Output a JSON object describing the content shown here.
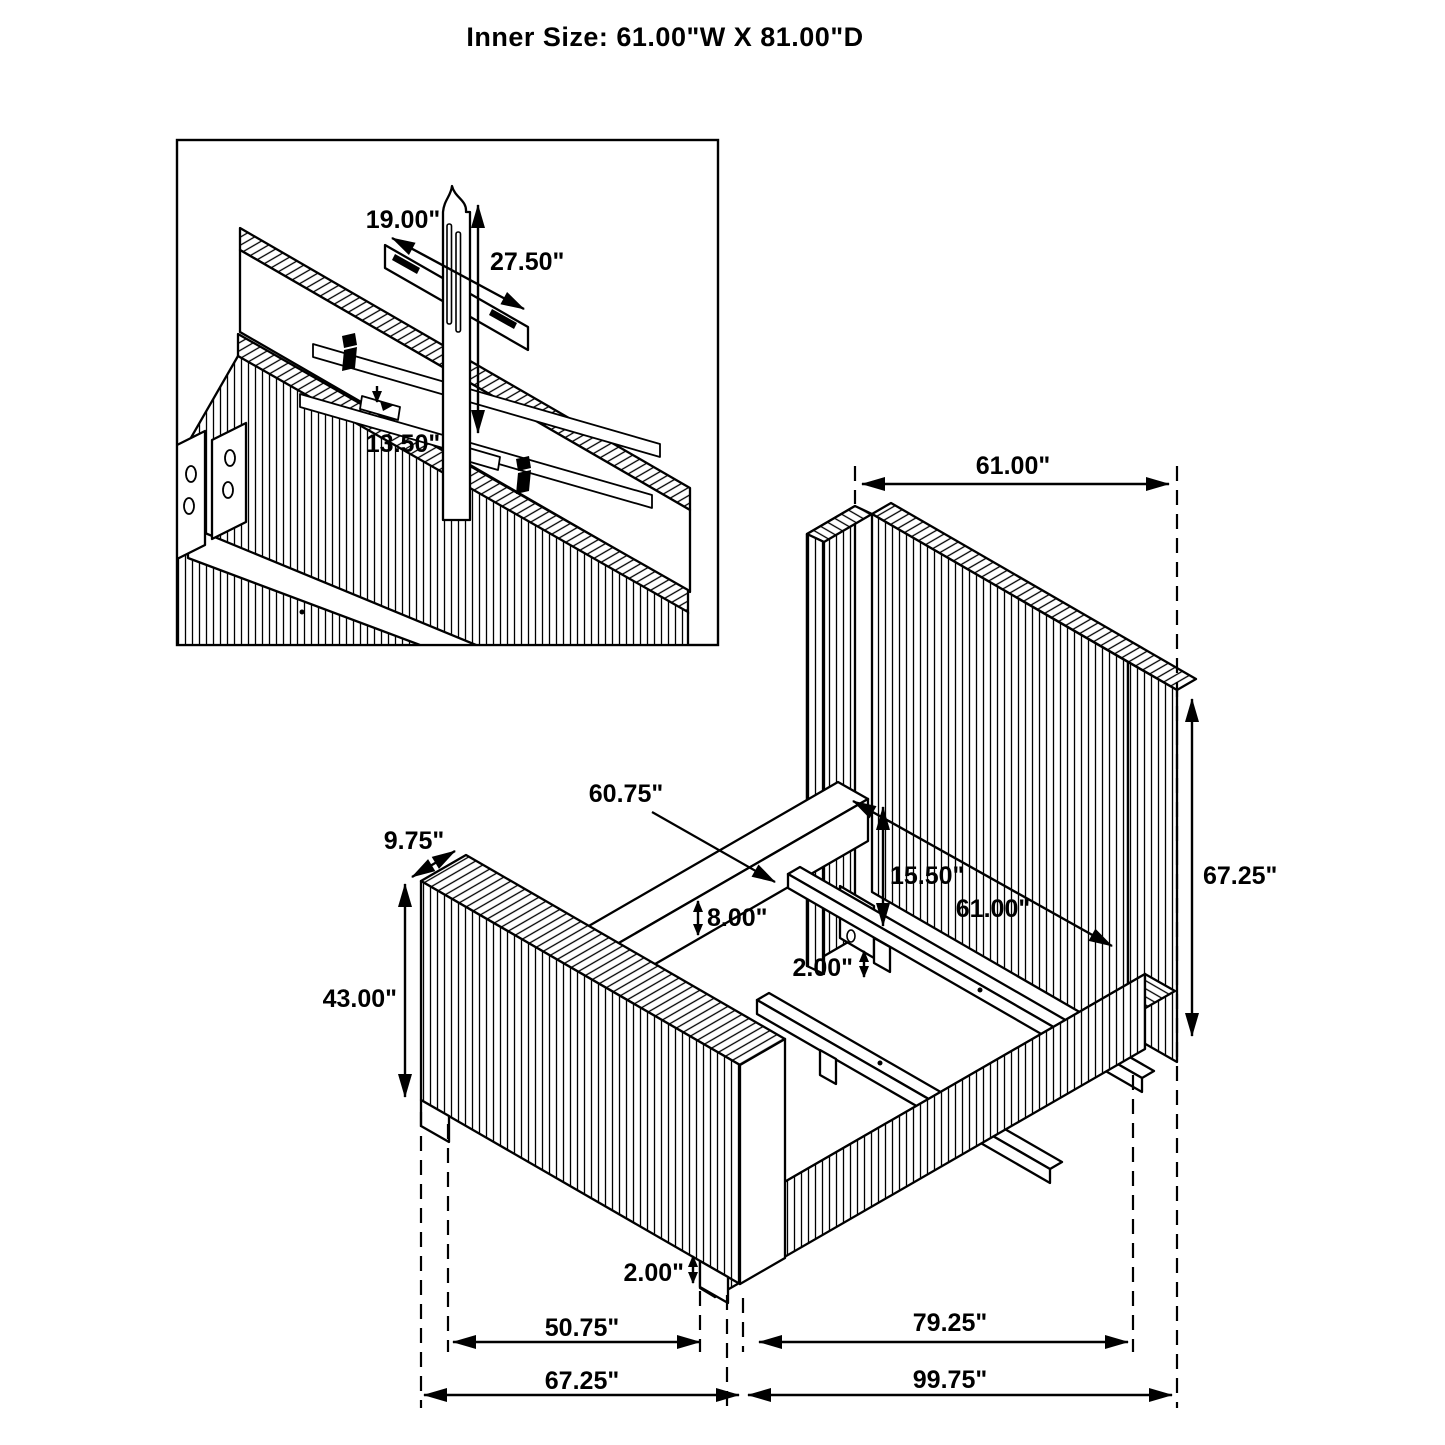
{
  "title": "Inner Size: 61.00\"W X 81.00\"D",
  "colors": {
    "line": "#000000",
    "background": "#ffffff"
  },
  "inset_detail": {
    "dim_bracket_length": "19.00\"",
    "dim_post_height": "27.50\"",
    "dim_bracket_offset": "13.50\""
  },
  "main_view": {
    "dim_headboard_width_top": "61.00\"",
    "dim_headboard_height": "67.25\"",
    "dim_slat_length": "60.75\"",
    "dim_footboard_thickness": "9.75\"",
    "dim_footboard_height": "43.00\"",
    "dim_headboard_clearance": "15.50\"",
    "dim_rail_height": "8.00\"",
    "dim_inner_width": "61.00\"",
    "dim_slat_leg_height": "2.00\"",
    "dim_footboard_leg_height": "2.00\"",
    "dim_footboard_inner_width": "50.75\"",
    "dim_inner_depth": "79.25\"",
    "dim_footboard_outer_width": "67.25\"",
    "dim_outer_depth": "99.75\""
  }
}
